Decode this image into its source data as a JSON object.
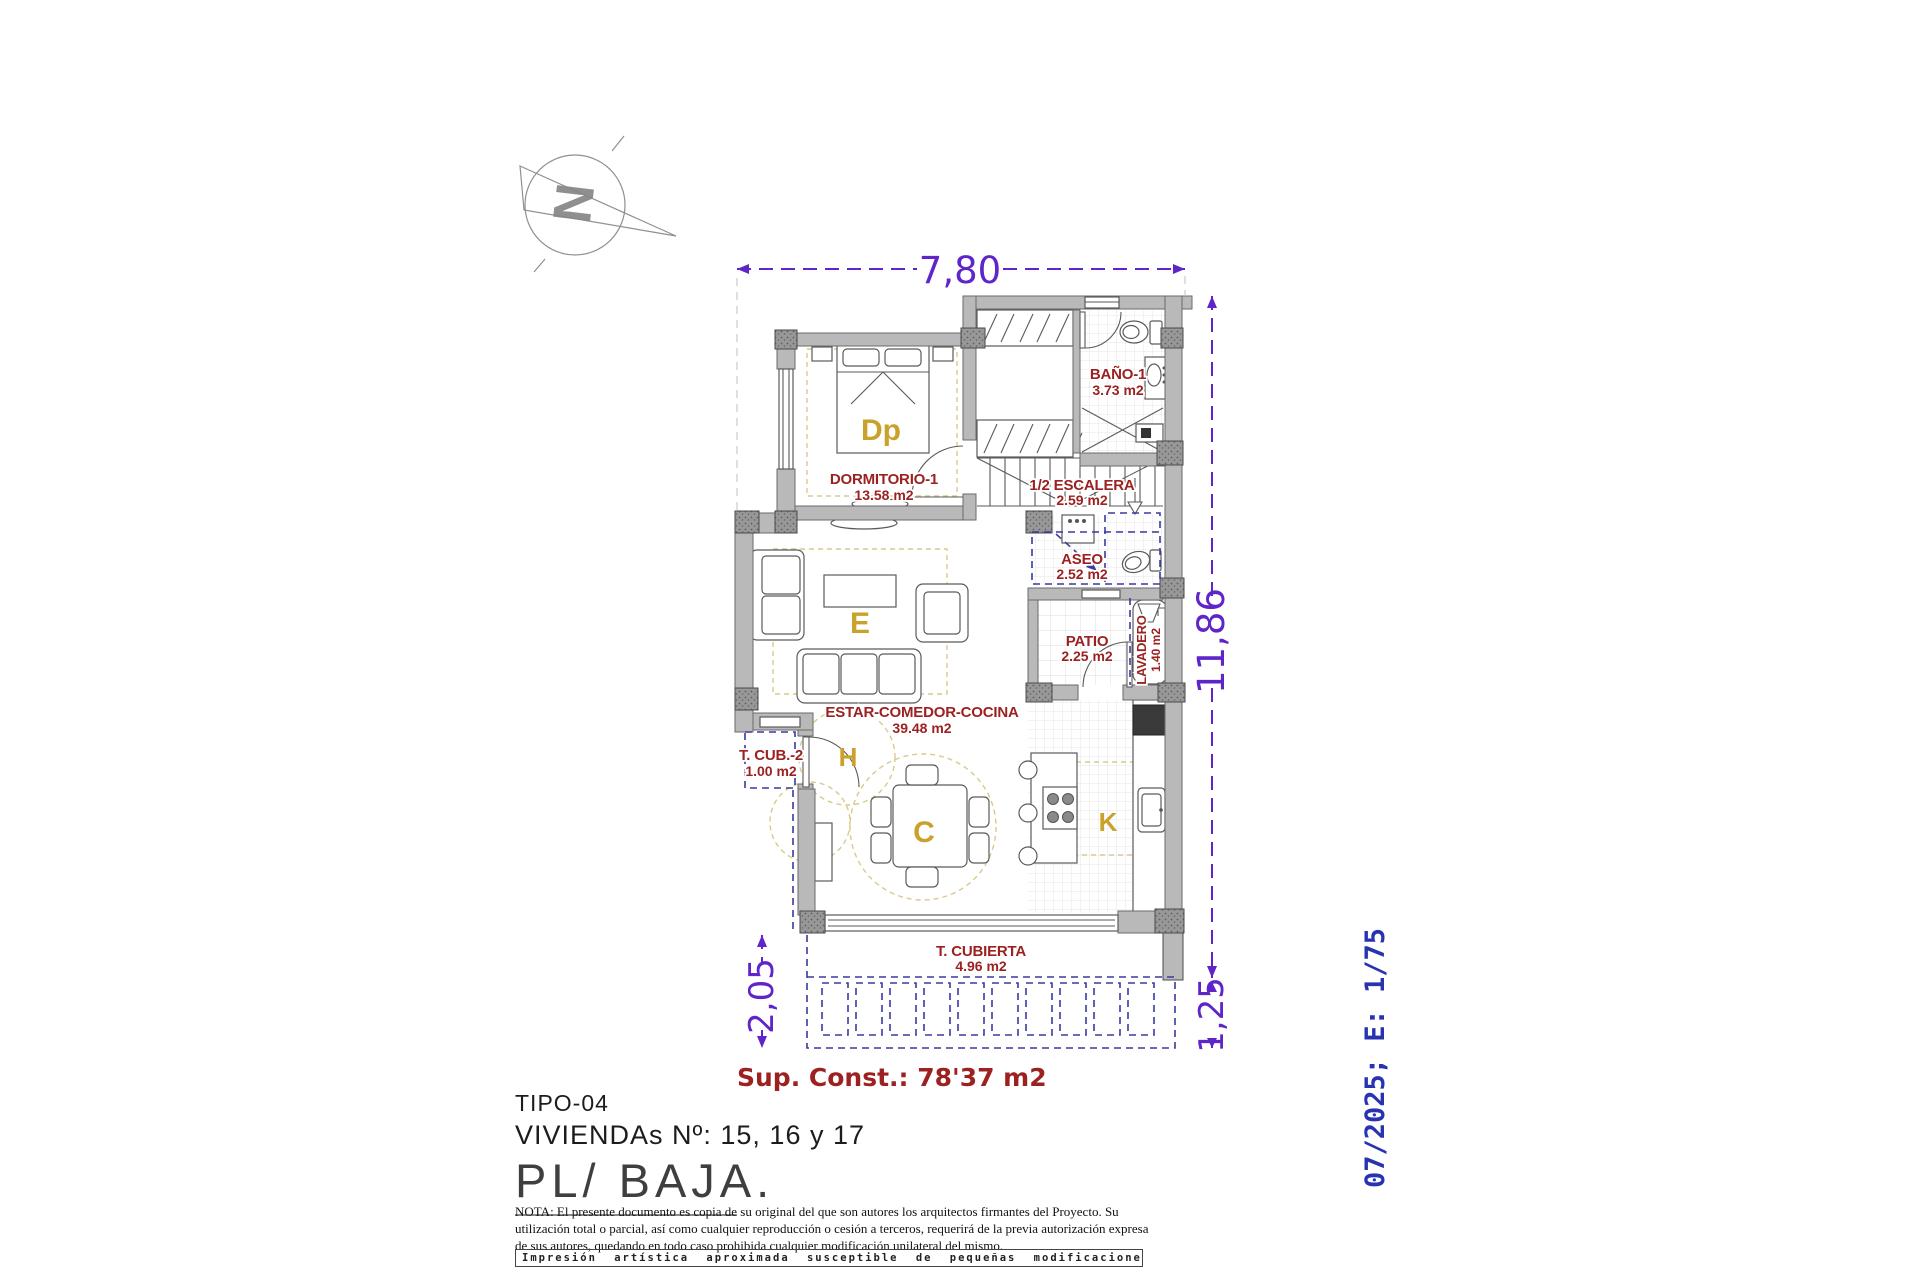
{
  "compass": {
    "letter": "N"
  },
  "dims": {
    "top": "7,80",
    "right": "11,86",
    "porch_depth": "2,05",
    "porch_right": "1,25"
  },
  "rooms": {
    "dormitorio": {
      "name": "DORMITORIO-1",
      "area": "13.58 m2",
      "letter": "Dp"
    },
    "bano": {
      "name": "BAÑO-1",
      "area": "3.73 m2"
    },
    "escalera": {
      "name": "1/2 ESCALERA",
      "area": "2.59 m2"
    },
    "aseo": {
      "name": "ASEO",
      "area": "2.52 m2"
    },
    "patio": {
      "name": "PATIO",
      "area": "2.25 m2"
    },
    "lavadero": {
      "name": "LAVADERO",
      "area": "1.40 m2"
    },
    "estar": {
      "name": "ESTAR-COMEDOR-COCINA",
      "area": "39.48 m2",
      "letter_estar": "E",
      "letter_hall": "H",
      "letter_comedor": "C",
      "letter_cocina": "K"
    },
    "tcub2": {
      "name": "T. CUB.-2",
      "area": "1.00 m2"
    },
    "tcubierta": {
      "name": "T. CUBIERTA",
      "area": "4.96 m2"
    }
  },
  "summary": {
    "sup_const": "Sup. Const.: 78'37 m2"
  },
  "title_block": {
    "tipo": "TIPO-04",
    "viviendas": "VIVIENDAs Nº: 15, 16 y 17",
    "planta": "PL/ BAJA."
  },
  "stamp": {
    "date_scale": "07/2025; E: 1/75"
  },
  "notes": {
    "nota": "NOTA: El presente documento es copia de su original del que son autores los arquitectos firmantes del Proyecto. Su utilización total o parcial, así como cualquier reproducción o cesión a terceros, requerirá  de la previa autorización expresa de sus autores, quedando en todo caso prohibida cualquier modificación unilateral del mismo.",
    "impresion": "Impresión artística aproximada susceptible de pequeñas modificaciones."
  },
  "colors": {
    "dimension_purple": "#5f25c9",
    "room_label_red": "#9c2121",
    "zone_letter_gold": "#c9a22b",
    "stamp_blue": "#2733b0",
    "wall_gray": "#b9b9b9",
    "reform_navy": "#3a3aa0"
  }
}
